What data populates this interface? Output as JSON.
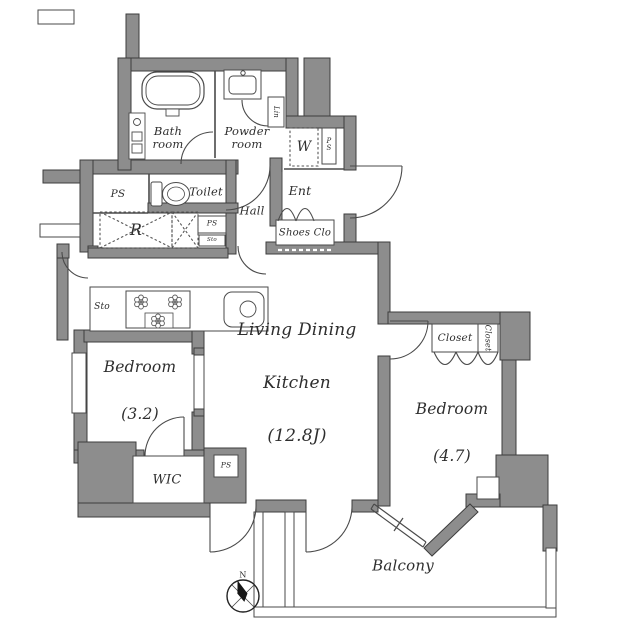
{
  "plan": {
    "compass_north": "N",
    "rooms": {
      "living_dining_kitchen": {
        "line1": "Living Dining",
        "line2": "Kitchen",
        "area": "(12.8J)"
      },
      "bedroom_west": {
        "label": "Bedroom",
        "area": "(3.2)"
      },
      "bedroom_east": {
        "label": "Bedroom",
        "area": "(4.7)"
      },
      "balcony": {
        "label": "Balcony"
      },
      "bath": {
        "label": "Bath\nroom"
      },
      "powder": {
        "label": "Powder\nroom"
      },
      "toilet": {
        "label": "Toilet"
      },
      "hall": {
        "label": "Hall"
      },
      "entrance": {
        "label": "Ent"
      },
      "shoes_closet": {
        "label": "Shoes Clo"
      },
      "wic": {
        "label": "WIC"
      },
      "closet_main": {
        "label": "Closet"
      },
      "closet_side": {
        "label": "Closet"
      }
    },
    "fixtures": {
      "washer": "W",
      "linen": "Lin",
      "refrigerator": "R",
      "storage_kitchen": "Sto",
      "storage_small": "Sto",
      "pipe_space_1": "PS",
      "pipe_space_2": "PS",
      "pipe_space_entrance": "PS",
      "pipe_space_wic": "PS"
    },
    "colors": {
      "wall": "#8d8d8d",
      "line": "#3f3f3f",
      "text": "#2e2e2e",
      "background": "#ffffff"
    }
  }
}
